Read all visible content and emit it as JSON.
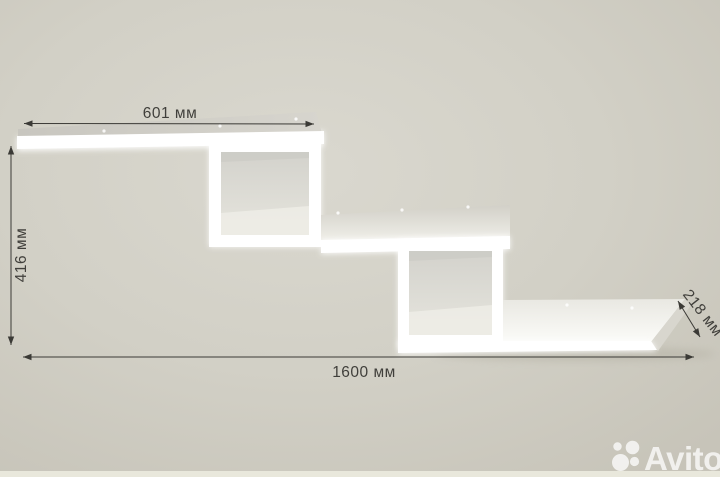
{
  "image": {
    "watermark": "Avito"
  },
  "dimensions": {
    "top_width": "601 мм",
    "left_height": "416 мм",
    "right_depth": "218 мм",
    "bottom_width": "1600 мм"
  },
  "icons": {
    "watermark_logo": "avito-circles-icon"
  },
  "colors": {
    "background": "#d2cfc6",
    "background_edge": "#c7c4b9",
    "shelf_white": "#ffffff",
    "shelf_face_gray": "#cfcdc6",
    "dimension_line": "#3b3a36",
    "dimension_text": "#403f3b",
    "watermark": "#ffffff",
    "bottom_strip": "#e9e8dc"
  }
}
